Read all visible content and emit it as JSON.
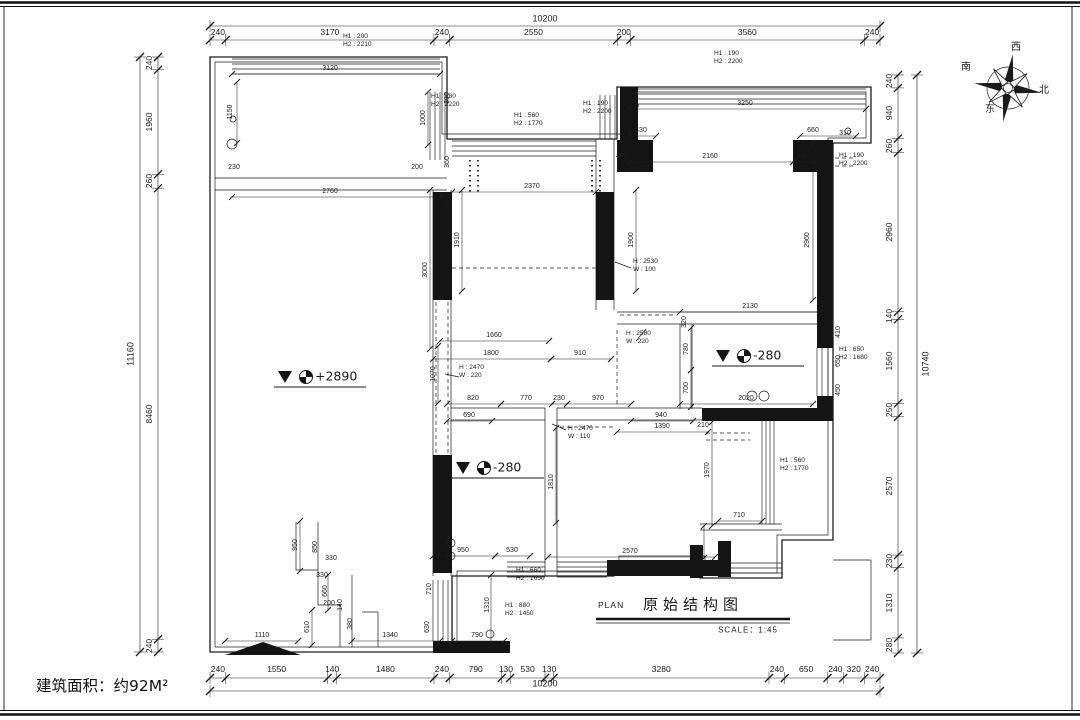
{
  "sheet": {
    "area_label": "建筑面积：约92M²",
    "title_block": {
      "plan_label": "PLAN",
      "title": "原始结构图",
      "scale_label": "SCALE：1:45"
    },
    "compass": {
      "labels": [
        [
          "西",
          1016,
          48
        ],
        [
          "南",
          966,
          68
        ],
        [
          "北",
          1044,
          91
        ],
        [
          "东",
          990,
          110
        ]
      ]
    }
  },
  "chains": {
    "top": {
      "total": "10200",
      "segments": [
        "240",
        "3170",
        "240",
        "2550",
        "200",
        "3560",
        "240"
      ]
    },
    "bottom": {
      "total": "10200",
      "segments": [
        "240",
        "1550",
        "140",
        "1480",
        "240",
        "790",
        "130",
        "530",
        "130",
        "3280",
        "240",
        "650",
        "240",
        "320",
        "240"
      ]
    },
    "left": {
      "total": "11160",
      "segments": [
        "240",
        "1960",
        "260",
        "8460",
        "240"
      ]
    },
    "right": {
      "total": "10740",
      "segments": [
        "240",
        "940",
        "260",
        "2960",
        "140",
        "1560",
        "250",
        "2570",
        "230",
        "1310",
        "280"
      ]
    }
  },
  "labels": {
    "dims": [
      [
        "3120",
        330,
        69,
        0
      ],
      [
        "2760",
        330,
        192,
        0
      ],
      [
        "1150",
        231,
        112,
        -90
      ],
      [
        "390",
        448,
        98,
        -90
      ],
      [
        "1000",
        424,
        118,
        -90
      ],
      [
        "360",
        448,
        162,
        -90
      ],
      [
        "230",
        234,
        168,
        0
      ],
      [
        "200",
        417,
        168,
        0
      ],
      [
        "2370",
        532,
        187,
        0
      ],
      [
        "700",
        448,
        205,
        -90
      ],
      [
        "1910",
        458,
        240,
        -90
      ],
      [
        "3000",
        426,
        270,
        -90
      ],
      [
        "3250",
        745,
        104,
        0
      ],
      [
        "250",
        633,
        107,
        0
      ],
      [
        "430",
        641,
        131,
        0
      ],
      [
        "660",
        813,
        131,
        0
      ],
      [
        "310",
        845,
        134,
        0
      ],
      [
        "400",
        622,
        157,
        0
      ],
      [
        "2160",
        710,
        157,
        0
      ],
      [
        "410",
        803,
        157,
        0
      ],
      [
        "1900",
        632,
        240,
        -90
      ],
      [
        "2960",
        808,
        240,
        -90
      ],
      [
        "2130",
        750,
        307,
        0
      ],
      [
        "320",
        685,
        322,
        -90
      ],
      [
        "780",
        687,
        349,
        -90
      ],
      [
        "700",
        687,
        388,
        -90
      ],
      [
        "410",
        839,
        332,
        -90
      ],
      [
        "650",
        839,
        361,
        -90
      ],
      [
        "450",
        839,
        390,
        -90
      ],
      [
        "2020",
        746,
        399,
        0
      ],
      [
        "1660",
        494,
        336,
        0
      ],
      [
        "1800",
        491,
        354,
        0
      ],
      [
        "910",
        580,
        354,
        0
      ],
      [
        "1070",
        434,
        374,
        -90
      ],
      [
        "820",
        473,
        399,
        0
      ],
      [
        "770",
        526,
        399,
        0
      ],
      [
        "230",
        559,
        399,
        0
      ],
      [
        "970",
        598,
        399,
        0
      ],
      [
        "690",
        469,
        416,
        0
      ],
      [
        "940",
        661,
        416,
        0
      ],
      [
        "1390",
        662,
        427,
        0
      ],
      [
        "210",
        703,
        426,
        0
      ],
      [
        "950",
        463,
        551,
        0
      ],
      [
        "530",
        512,
        551,
        0
      ],
      [
        "2570",
        630,
        552,
        0
      ],
      [
        "1810",
        552,
        482,
        -90
      ],
      [
        "710",
        739,
        516,
        0
      ],
      [
        "1970",
        708,
        470,
        -90
      ],
      [
        "600",
        700,
        551,
        -90
      ],
      [
        "950",
        296,
        545,
        -90
      ],
      [
        "850",
        316,
        547,
        -90
      ],
      [
        "330",
        331,
        559,
        0
      ],
      [
        "330",
        322,
        576,
        0
      ],
      [
        "660",
        326,
        591,
        -90
      ],
      [
        "200",
        329,
        604,
        0
      ],
      [
        "610",
        308,
        627,
        -90
      ],
      [
        "140",
        341,
        605,
        -90
      ],
      [
        "380",
        351,
        624,
        -90
      ],
      [
        "630",
        428,
        627,
        -90
      ],
      [
        "710",
        430,
        589,
        -90
      ],
      [
        "1310",
        488,
        605,
        -90
      ],
      [
        "1340",
        390,
        636,
        0
      ],
      [
        "790",
        477,
        636,
        0
      ],
      [
        "1110",
        262,
        636,
        0
      ]
    ],
    "annotations": [
      [
        "H1 : 200\nH2 : 2210",
        343,
        41
      ],
      [
        "H1 : 180\nH2 : 2220",
        431,
        101
      ],
      [
        "H1 : 560\nH2 : 1770",
        514,
        120
      ],
      [
        "H1 : 190\nH2 : 2200",
        583,
        108
      ],
      [
        "H1 : 190\nH2 : 2200",
        714,
        58
      ],
      [
        "H1 : 190\nH2 : 2200",
        839,
        160
      ],
      [
        "H : 2530\nW : 100",
        633,
        266
      ],
      [
        "H : 2470\nW : 220",
        459,
        372
      ],
      [
        "H : 2580\nW : 220",
        626,
        338
      ],
      [
        "H : 2470\nW : 110",
        568,
        433
      ],
      [
        "H1 : 650\nH2 : 1680",
        839,
        354
      ],
      [
        "H1 : 560\nH2 : 1770",
        780,
        465
      ],
      [
        "H1 : 660\nH2 : 1650",
        516,
        575
      ],
      [
        "H1 : 880\nH2 : 1450",
        505,
        610
      ]
    ],
    "levels": [
      [
        "+2890",
        322,
        377
      ],
      [
        "-280",
        760,
        356
      ],
      [
        "-280",
        500,
        468
      ]
    ]
  }
}
